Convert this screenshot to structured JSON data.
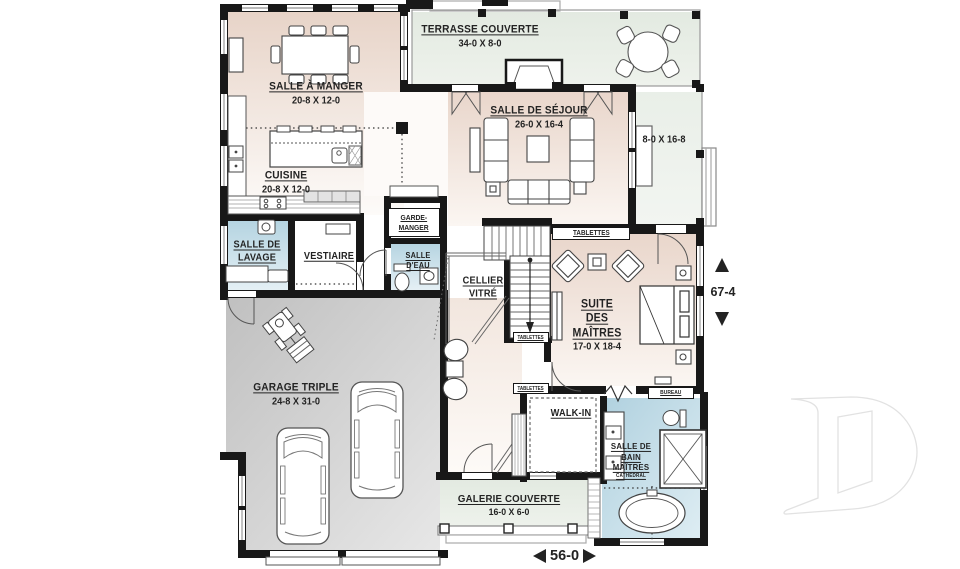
{
  "colors": {
    "wall": "#181818",
    "room_warm": "#e7d3c7",
    "room_green": "#e3eae1",
    "room_blue": "#b5d4e1",
    "garage_gray": "#c2c2c2",
    "label_text": "#232323",
    "logo_gray": "#e3e3e3"
  },
  "rooms": {
    "dining": {
      "name": "SALLE À MANGER",
      "dims": "20-8 X 12-0"
    },
    "terrace": {
      "name": "TERRASSE COUVERTE",
      "dims": "34-0 X 8-0"
    },
    "living": {
      "name": "SALLE DE SÉJOUR",
      "dims": "26-0 X 16-4"
    },
    "side_porch": {
      "dims": "8-0 X 16-8"
    },
    "kitchen": {
      "name": "CUISINE",
      "dims": "20-8 X 12-0"
    },
    "pantry": {
      "line1": "GARDE-",
      "line2": "MANGER"
    },
    "laundry": {
      "line1": "SALLE DE",
      "line2": "LAVAGE"
    },
    "vestibule": {
      "name": "VESTIAIRE"
    },
    "powder": {
      "line1": "SALLE",
      "line2": "D'EAU"
    },
    "cellar": {
      "line1": "CELLIER",
      "line2": "VITRÉ"
    },
    "master": {
      "line1": "SUITE",
      "line2": "DES",
      "line3": "MAÎTRES",
      "dims": "17-0 X 18-4"
    },
    "garage": {
      "name": "GARAGE TRIPLE",
      "dims": "24-8 X 31-0"
    },
    "walkin": {
      "name": "WALK-IN"
    },
    "master_bath": {
      "line1": "SALLE DE",
      "line2": "BAIN",
      "line3": "MAÎTRES",
      "note": "CATHÉDRAL"
    },
    "gallery": {
      "name": "GALERIE COUVERTE",
      "dims": "16-0 X 6-0"
    },
    "office": {
      "name": "BUREAU"
    },
    "shelves": {
      "name": "TABLETTES"
    }
  },
  "dimensions": {
    "overall_depth": "67-4",
    "overall_width": "56-0"
  }
}
